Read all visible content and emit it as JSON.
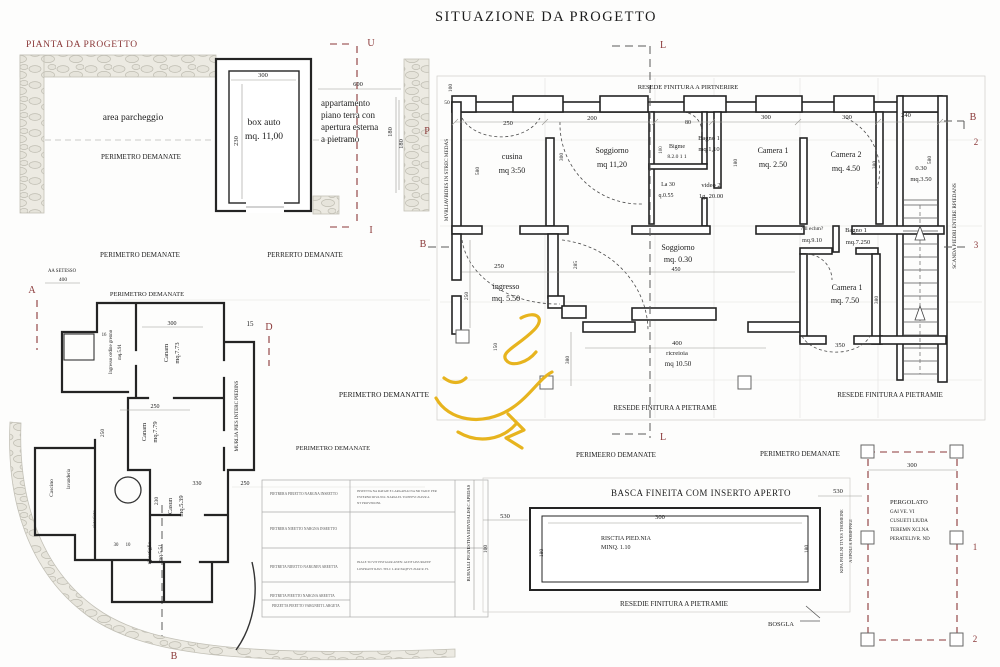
{
  "title": "SITUAZIONE DA PROGETTO",
  "plan_label": "PIANTA DA PROGETTO",
  "colors": {
    "ink": "#1c1c1c",
    "accent": "#8a3838",
    "dim": "#555555",
    "wall": "#242424",
    "stone_fill": "#eceae2",
    "stone_line": "#bfbdb2",
    "yellow": "#e7b41e"
  },
  "labels": [
    {
      "n": "area-parcheggio-label",
      "t": "area parcheggio",
      "x": 133,
      "y": 120,
      "s": 9.5
    },
    {
      "n": "perimetro-demanate-1",
      "t": "PERIMETRO DEMANATE",
      "x": 141,
      "y": 159,
      "s": 7
    },
    {
      "n": "box-auto-label",
      "t": "box auto",
      "x": 264,
      "y": 125,
      "s": 9.5
    },
    {
      "n": "box-auto-area",
      "t": "mq. 11,00",
      "x": 264,
      "y": 139,
      "s": 9.5
    },
    {
      "n": "dim-300-box",
      "t": "300",
      "x": 263,
      "y": 77,
      "s": 6.5
    },
    {
      "n": "dim-230-box",
      "t": "230",
      "x": 238,
      "y": 141,
      "s": 6.5,
      "r": -90
    },
    {
      "n": "apartment-line-1",
      "t": "appartamento",
      "x": 321,
      "y": 106,
      "s": 9,
      "a": "start"
    },
    {
      "n": "apartment-line-2",
      "t": "piano terra con",
      "x": 321,
      "y": 118,
      "s": 9,
      "a": "start"
    },
    {
      "n": "apartment-line-3",
      "t": "apertura esterna",
      "x": 321,
      "y": 130,
      "s": 9,
      "a": "start"
    },
    {
      "n": "apartment-line-4",
      "t": "a pietramo",
      "x": 321,
      "y": 142,
      "s": 9,
      "a": "start"
    },
    {
      "n": "dim-600",
      "t": "600",
      "x": 358,
      "y": 86,
      "s": 6.5
    },
    {
      "n": "dim-180-apartment",
      "t": "180",
      "x": 392,
      "y": 132,
      "s": 6.5,
      "r": -90
    },
    {
      "n": "section-marker-u",
      "t": "U",
      "x": 371,
      "y": 46,
      "s": 10,
      "c": "accent"
    },
    {
      "n": "section-marker-i",
      "t": "I",
      "x": 371,
      "y": 233,
      "s": 10,
      "c": "accent"
    },
    {
      "n": "perimetro-demanate-2",
      "t": "PERIMETRO DEMANATE",
      "x": 140,
      "y": 257,
      "s": 7
    },
    {
      "n": "perrerto-demanate",
      "t": "PERRERTO DEMANATE",
      "x": 305,
      "y": 257,
      "s": 7
    },
    {
      "n": "perimetro-demanate-3",
      "t": "PERIMETRO DEMANATE",
      "x": 147,
      "y": 296,
      "s": 6.5
    },
    {
      "n": "aa-setesso",
      "t": "AA SETESSO",
      "x": 62,
      "y": 272,
      "s": 4.8
    },
    {
      "n": "dim-400-left",
      "t": "400",
      "x": 63,
      "y": 281,
      "s": 5.5
    },
    {
      "n": "section-marker-a",
      "t": "A",
      "x": 32,
      "y": 293,
      "s": 10,
      "c": "accent"
    },
    {
      "n": "dim-15",
      "t": "15",
      "x": 250,
      "y": 326,
      "s": 7
    },
    {
      "n": "section-marker-d",
      "t": "D",
      "x": 269,
      "y": 330,
      "s": 10,
      "c": "accent"
    },
    {
      "n": "section-marker-l-top",
      "t": "L",
      "x": 663,
      "y": 48,
      "s": 10,
      "c": "accent"
    },
    {
      "n": "section-marker-l-bottom",
      "t": "L",
      "x": 663,
      "y": 440,
      "s": 10,
      "c": "accent"
    },
    {
      "n": "resede-finitura-top",
      "t": "RESEDE FINITURA A PIRTNERIRE",
      "x": 688,
      "y": 89,
      "s": 6.5
    },
    {
      "n": "section-marker-b-right",
      "t": "B",
      "x": 973,
      "y": 120,
      "s": 10,
      "c": "accent"
    },
    {
      "n": "section-marker-2-right",
      "t": "2",
      "x": 976,
      "y": 145,
      "s": 9,
      "c": "accent"
    },
    {
      "n": "section-marker-3-right",
      "t": "3",
      "x": 976,
      "y": 248,
      "s": 9,
      "c": "accent"
    },
    {
      "n": "section-marker-b-left",
      "t": "B",
      "x": 423,
      "y": 247,
      "s": 10,
      "c": "accent"
    },
    {
      "n": "section-marker-p-left",
      "t": "P",
      "x": 427,
      "y": 134,
      "s": 10,
      "c": "accent"
    },
    {
      "n": "dim-100-topleft",
      "t": "100",
      "x": 452,
      "y": 88,
      "s": 5.5,
      "r": -90
    },
    {
      "n": "dim-50-topleft",
      "t": "50",
      "x": 447,
      "y": 104,
      "s": 5.5
    },
    {
      "n": "dim-250-top",
      "t": "250",
      "x": 508,
      "y": 125,
      "s": 6.5
    },
    {
      "n": "dim-200-top",
      "t": "200",
      "x": 592,
      "y": 120,
      "s": 6.5
    },
    {
      "n": "dim-80-top",
      "t": "80",
      "x": 688,
      "y": 124,
      "s": 6
    },
    {
      "n": "dim-300-top-1",
      "t": "300",
      "x": 766,
      "y": 119,
      "s": 6.5
    },
    {
      "n": "dim-300-top-2",
      "t": "300",
      "x": 847,
      "y": 119,
      "s": 6.5
    },
    {
      "n": "dim-240-top",
      "t": "240",
      "x": 906,
      "y": 117,
      "s": 6.5
    },
    {
      "n": "dim-180-stone",
      "t": "180",
      "x": 403,
      "y": 144,
      "s": 6.5,
      "r": -90
    },
    {
      "n": "wall-note-left-vertical",
      "t": "MVRLIAVBIDES IN STREC MEDAS",
      "x": 448,
      "y": 180,
      "s": 5.2,
      "r": -90
    },
    {
      "n": "room-cusina",
      "t": "cusina",
      "x": 512,
      "y": 159,
      "s": 8
    },
    {
      "n": "room-cusina-area",
      "t": "mq 3:50",
      "x": 512,
      "y": 173,
      "s": 8
    },
    {
      "n": "dim-580-cusina",
      "t": "580",
      "x": 479,
      "y": 171,
      "s": 5.5,
      "r": -90
    },
    {
      "n": "room-soggiorno-1",
      "t": "Soggiorno",
      "x": 612,
      "y": 153,
      "s": 8
    },
    {
      "n": "room-soggiorno-1-area",
      "t": "mq 11,20",
      "x": 612,
      "y": 167,
      "s": 8
    },
    {
      "n": "dim-300-soggiorno",
      "t": "300",
      "x": 563,
      "y": 157,
      "s": 5.5,
      "r": -90
    },
    {
      "n": "room-bigme",
      "t": "Bigme",
      "x": 677,
      "y": 148,
      "s": 6
    },
    {
      "n": "room-bigme-area",
      "t": "8.2.0 1 1",
      "x": 677,
      "y": 158,
      "s": 5.5
    },
    {
      "n": "room-bagno1-top",
      "t": "Bagno 1",
      "x": 709,
      "y": 140,
      "s": 6.5
    },
    {
      "n": "room-bagno1-top-area",
      "t": "mq.1,10",
      "x": 709,
      "y": 151,
      "s": 6.5
    },
    {
      "n": "dim-100-bagno",
      "t": "100",
      "x": 662,
      "y": 150,
      "s": 5,
      "r": -90
    },
    {
      "n": "note-la30",
      "t": "La 30",
      "x": 668,
      "y": 186,
      "s": 6
    },
    {
      "n": "note-q055",
      "t": "q.0.55",
      "x": 666,
      "y": 197,
      "s": 6
    },
    {
      "n": "room-video2",
      "t": "video 2",
      "x": 711,
      "y": 187,
      "s": 6.5
    },
    {
      "n": "room-video2-area",
      "t": "1g. 20.00",
      "x": 711,
      "y": 198,
      "s": 6.5
    },
    {
      "n": "room-camera1-top",
      "t": "Camera 1",
      "x": 773,
      "y": 153,
      "s": 8
    },
    {
      "n": "room-camera1-top-area",
      "t": "mq. 2.50",
      "x": 773,
      "y": 167,
      "s": 8
    },
    {
      "n": "dim-180-camera1",
      "t": "180",
      "x": 737,
      "y": 163,
      "s": 5.5,
      "r": -90
    },
    {
      "n": "room-camera2",
      "t": "Camera 2",
      "x": 846,
      "y": 157,
      "s": 8
    },
    {
      "n": "room-camera2-area",
      "t": "mq. 4.50",
      "x": 846,
      "y": 171,
      "s": 8
    },
    {
      "n": "dim-380-camera2",
      "t": "380",
      "x": 876,
      "y": 165,
      "s": 5.5,
      "r": -90
    },
    {
      "n": "room-030",
      "t": "0.30",
      "x": 921,
      "y": 170,
      "s": 6.5
    },
    {
      "n": "room-030-area",
      "t": "mq.3.50",
      "x": 921,
      "y": 181,
      "s": 6.5
    },
    {
      "n": "dim-580-stair",
      "t": "580",
      "x": 931,
      "y": 160,
      "s": 5.5,
      "r": -90
    },
    {
      "n": "stair-note-vertical",
      "t": "SCANDA PIEDRI ENTIRE RPIEDANS",
      "x": 956,
      "y": 226,
      "s": 5.2,
      "r": -90
    },
    {
      "n": "note-echm",
      "t": "?ill echm?",
      "x": 812,
      "y": 230,
      "s": 5.5
    },
    {
      "n": "note-mq910",
      "t": "mq.9.10",
      "x": 812,
      "y": 242,
      "s": 6
    },
    {
      "n": "room-bagno1-lower",
      "t": "Bagno 1",
      "x": 856,
      "y": 232,
      "s": 6.5
    },
    {
      "n": "room-bagno1-lower-area",
      "t": "mq.7.250",
      "x": 858,
      "y": 244,
      "s": 6.5
    },
    {
      "n": "room-camera1-lower",
      "t": "Camera 1",
      "x": 847,
      "y": 290,
      "s": 8
    },
    {
      "n": "room-camera1-lower-area",
      "t": "mq. 7.50",
      "x": 845,
      "y": 303,
      "s": 8
    },
    {
      "n": "dim-380-camera1-lower",
      "t": "380",
      "x": 878,
      "y": 300,
      "s": 5.5,
      "r": -90
    },
    {
      "n": "dim-350-camera1-lower",
      "t": "350",
      "x": 840,
      "y": 347,
      "s": 6.5
    },
    {
      "n": "room-soggiorno-2",
      "t": "Soggiorno",
      "x": 678,
      "y": 250,
      "s": 8
    },
    {
      "n": "room-soggiorno-2-area",
      "t": "mq. 0.30",
      "x": 678,
      "y": 262,
      "s": 8
    },
    {
      "n": "dim-450",
      "t": "450",
      "x": 676,
      "y": 271,
      "s": 6
    },
    {
      "n": "dim-250-ingresso-top",
      "t": "250",
      "x": 499,
      "y": 268,
      "s": 6.5
    },
    {
      "n": "dim-250-ingresso-left",
      "t": "250",
      "x": 468,
      "y": 296,
      "s": 5.5,
      "r": -90
    },
    {
      "n": "room-ingresso",
      "t": "ingresso",
      "x": 506,
      "y": 289,
      "s": 8
    },
    {
      "n": "room-ingresso-area",
      "t": "mq. 5.50",
      "x": 506,
      "y": 301,
      "s": 8
    },
    {
      "n": "dim-150-ingresso",
      "t": "150",
      "x": 497,
      "y": 347,
      "s": 5.5,
      "r": -90
    },
    {
      "n": "dim-380-lower",
      "t": "380",
      "x": 569,
      "y": 360,
      "s": 5.5,
      "r": -90
    },
    {
      "n": "dim-285",
      "t": "285",
      "x": 577,
      "y": 265,
      "s": 5.5,
      "r": -90
    },
    {
      "n": "dim-400-ricreioia",
      "t": "400",
      "x": 677,
      "y": 345,
      "s": 6.5
    },
    {
      "n": "note-ricreioia",
      "t": "ricreioia",
      "x": 677,
      "y": 355,
      "s": 6.5
    },
    {
      "n": "note-ricreioia-area",
      "t": "mq 10.50",
      "x": 678,
      "y": 366,
      "s": 7
    },
    {
      "n": "resede-finitura-bottom",
      "t": "RESEDE FINITURA A PIETRAME",
      "x": 665,
      "y": 410,
      "s": 7
    },
    {
      "n": "resede-finitura-right",
      "t": "RESEDE FINITURA A PIETRAMIE",
      "x": 890,
      "y": 397,
      "s": 7
    },
    {
      "n": "perimetro-demanatte",
      "t": "PERIMETRO DEMANATTE",
      "x": 384,
      "y": 397,
      "s": 7.5
    },
    {
      "n": "perimetro-demanate-4",
      "t": "PERIMETRO DEMANATE",
      "x": 333,
      "y": 450,
      "s": 6.5
    },
    {
      "n": "perimeero-demanate",
      "t": "PERIMEERO DEMANATE",
      "x": 616,
      "y": 457,
      "s": 7
    },
    {
      "n": "perimetro-demanate-5",
      "t": "PERIMETRO DEMANATE",
      "x": 800,
      "y": 456,
      "s": 7
    },
    {
      "n": "room-canam-1",
      "t": "Canam",
      "x": 168,
      "y": 353,
      "s": 6.5,
      "r": -90
    },
    {
      "n": "room-canam-1-area",
      "t": "mq.7.73",
      "x": 179,
      "y": 353,
      "s": 6.5,
      "r": -90
    },
    {
      "n": "room-ingresso-ordine",
      "t": "Ingresso ordine grenno",
      "x": 112,
      "y": 352,
      "s": 4.8,
      "r": -90
    },
    {
      "n": "room-ingresso-ordine-area",
      "t": "mq.5.91",
      "x": 121,
      "y": 352,
      "s": 4.8,
      "r": -90
    },
    {
      "n": "dim-300-ll",
      "t": "300",
      "x": 172,
      "y": 325,
      "s": 6
    },
    {
      "n": "dim-16-ll",
      "t": "16",
      "x": 104,
      "y": 336,
      "s": 4.8
    },
    {
      "n": "dim-250-ll-1",
      "t": "250",
      "x": 155,
      "y": 408,
      "s": 6
    },
    {
      "n": "room-canam-2",
      "t": "Canam",
      "x": 146,
      "y": 432,
      "s": 6.5,
      "r": -90
    },
    {
      "n": "room-canam-2-area",
      "t": "mq.7.79",
      "x": 157,
      "y": 432,
      "s": 6.5,
      "r": -90
    },
    {
      "n": "dim-250-ll-left",
      "t": "250",
      "x": 104,
      "y": 433,
      "s": 5.5,
      "r": -90
    },
    {
      "n": "dim-330-ll",
      "t": "330",
      "x": 197,
      "y": 485,
      "s": 6
    },
    {
      "n": "dim-250-ll-2",
      "t": "250",
      "x": 245,
      "y": 485,
      "s": 6
    },
    {
      "n": "dim-230-ll",
      "t": "230",
      "x": 158,
      "y": 501,
      "s": 5.5,
      "r": -90
    },
    {
      "n": "room-casun",
      "t": "Casun",
      "x": 172,
      "y": 506,
      "s": 6.5,
      "r": -90
    },
    {
      "n": "room-casun-area",
      "t": "mq.5.39",
      "x": 183,
      "y": 506,
      "s": 6.5,
      "r": -90
    },
    {
      "n": "room-ripostiglio",
      "t": "ripostiglio",
      "x": 151,
      "y": 553,
      "s": 5.5,
      "r": -90
    },
    {
      "n": "room-ripostiglio-area",
      "t": "mq.5.51",
      "x": 162,
      "y": 553,
      "s": 5.5,
      "r": -90
    },
    {
      "n": "room-cascino",
      "t": "Cascino",
      "x": 53,
      "y": 488,
      "s": 5.5,
      "r": -90
    },
    {
      "n": "room-lavanderia",
      "t": "lavanderia",
      "x": 70,
      "y": 479,
      "s": 4.8,
      "r": -90
    },
    {
      "n": "room-ristorioto",
      "t": "ristorioto",
      "x": 96,
      "y": 519,
      "s": 4.8,
      "r": -90
    },
    {
      "n": "dim-30-ll",
      "t": "30",
      "x": 116,
      "y": 546,
      "s": 4.8
    },
    {
      "n": "dim-10-ll",
      "t": "10",
      "x": 128,
      "y": 546,
      "s": 4.8
    },
    {
      "n": "wall-note-ll-vertical",
      "t": "MURLIA PIES INTERC PIEDINS",
      "x": 238,
      "y": 416,
      "s": 5,
      "r": -90
    },
    {
      "n": "section-marker-b-bottom",
      "t": "B",
      "x": 174,
      "y": 659,
      "s": 10,
      "c": "accent"
    },
    {
      "n": "table-row-1",
      "t": "PIETRERA PIEIETTO NARGNA INSEETTO",
      "x": 270,
      "y": 495,
      "s": 3.6,
      "c": "dim",
      "a": "start"
    },
    {
      "n": "table-row-2",
      "t": "PIETRERA NIEETTO NARGNA INSEETTO",
      "x": 270,
      "y": 530,
      "s": 3.6,
      "c": "dim",
      "a": "start"
    },
    {
      "n": "table-row-3",
      "t": "PIETRETA NIEETTO NARGNEN AREETTA",
      "x": 270,
      "y": 568,
      "s": 3.6,
      "c": "dim",
      "a": "start"
    },
    {
      "n": "table-row-4",
      "t": "PIETRETA PIEETTO NARGNA AREETTA",
      "x": 270,
      "y": 597,
      "s": 3.6,
      "c": "dim",
      "a": "start"
    },
    {
      "n": "table-row-5",
      "t": "PIEZETTA PIEETTO VARGNEIT LARGETA",
      "x": 272,
      "y": 607,
      "s": 3.6,
      "c": "dim",
      "a": "start"
    },
    {
      "n": "table-note-1a",
      "t": "INSEETTA NA RATAIE E LARGAPIAI NA NR VAICE PER",
      "x": 357,
      "y": 492,
      "s": 3.2,
      "c": "dim",
      "a": "start"
    },
    {
      "n": "table-note-1b",
      "t": "ESTERNO RIVA NLL NARGLEL TLIEEPVI ZIAVR A",
      "x": 357,
      "y": 498,
      "s": 3.2,
      "c": "dim",
      "a": "start"
    },
    {
      "n": "table-note-1c",
      "t": "NT PROVISIONL",
      "x": 357,
      "y": 504,
      "s": 3.2,
      "c": "dim",
      "a": "start"
    },
    {
      "n": "table-note-2a",
      "t": "INALE TO VIT PISTGGIR ANEN: ALTIF IAVURGEEP",
      "x": 357,
      "y": 563,
      "s": 3.2,
      "c": "dim",
      "a": "start"
    },
    {
      "n": "table-note-2b",
      "t": "LOSPRANT RAVI. TELC L.R.R PAQPVS ZIAR R. FL",
      "x": 357,
      "y": 570,
      "s": 3.2,
      "c": "dim",
      "a": "start"
    },
    {
      "n": "pool-note-left-vertical",
      "t": "BURALLI PIGNESTHA EDIVDALISEC APEDAS",
      "x": 470,
      "y": 533,
      "s": 4.6,
      "r": -90
    },
    {
      "n": "pool-title",
      "t": "BASCA FINEITA COM INSERTO APERTO",
      "x": 701,
      "y": 496,
      "s": 9,
      "ls": 0.5
    },
    {
      "n": "dim-300-pool",
      "t": "300",
      "x": 660,
      "y": 519,
      "s": 6.5
    },
    {
      "n": "pool-note-1",
      "t": "RISCTIA PIED.NIA",
      "x": 601,
      "y": 540,
      "s": 6,
      "a": "start"
    },
    {
      "n": "pool-note-2",
      "t": "MINQ. 1.10",
      "x": 601,
      "y": 549,
      "s": 6,
      "a": "start"
    },
    {
      "n": "dim-530-pool-left",
      "t": "530",
      "x": 505,
      "y": 518,
      "s": 6.5
    },
    {
      "n": "dim-530-pool-right",
      "t": "530",
      "x": 838,
      "y": 493,
      "s": 6.5
    },
    {
      "n": "dim-100-pool",
      "t": "100",
      "x": 487,
      "y": 549,
      "s": 5.5,
      "r": -90
    },
    {
      "n": "dim-180-pool-left",
      "t": "180",
      "x": 543,
      "y": 553,
      "s": 5.5,
      "r": -90
    },
    {
      "n": "dim-180-pool-right",
      "t": "180",
      "x": 808,
      "y": 549,
      "s": 5.5,
      "r": -90
    },
    {
      "n": "resedie-finitura-pool",
      "t": "RESEDIE FINITURA A PIETRAMIE",
      "x": 674,
      "y": 606,
      "s": 7
    },
    {
      "n": "note-bosgla",
      "t": "BOSGLA",
      "x": 781,
      "y": 626,
      "s": 6.5
    },
    {
      "n": "pool-note-right-vertical-1",
      "t": "KIPA PHELNI TIVES THOMEINE",
      "x": 843,
      "y": 541,
      "s": 4.4,
      "r": -90
    },
    {
      "n": "pool-note-right-vertical-2",
      "t": "A EPOLI A POMPPNGI",
      "x": 852,
      "y": 541,
      "s": 4.4,
      "r": -90
    },
    {
      "n": "dim-300-pergolato",
      "t": "300",
      "x": 912,
      "y": 467,
      "s": 6.5
    },
    {
      "n": "pergolato-title",
      "t": "PERGOLATO",
      "x": 890,
      "y": 504,
      "s": 6.5,
      "a": "start"
    },
    {
      "n": "pergolato-line-2",
      "t": "GAI VE. VI",
      "x": 890,
      "y": 513,
      "s": 5,
      "a": "start"
    },
    {
      "n": "pergolato-line-3",
      "t": "CUSUETI LIUDA",
      "x": 890,
      "y": 522,
      "s": 5,
      "a": "start"
    },
    {
      "n": "pergolato-line-4",
      "t": "TEREMN XCI.NA",
      "x": 890,
      "y": 531,
      "s": 5,
      "a": "start"
    },
    {
      "n": "pergolato-line-5",
      "t": "PERATELIVR. ND",
      "x": 890,
      "y": 540,
      "s": 5,
      "a": "start"
    },
    {
      "n": "section-marker-1-pergolato",
      "t": "1",
      "x": 975,
      "y": 550,
      "s": 9,
      "c": "accent"
    },
    {
      "n": "section-marker-2-pergolato",
      "t": "2",
      "x": 975,
      "y": 642,
      "s": 9,
      "c": "accent"
    }
  ]
}
